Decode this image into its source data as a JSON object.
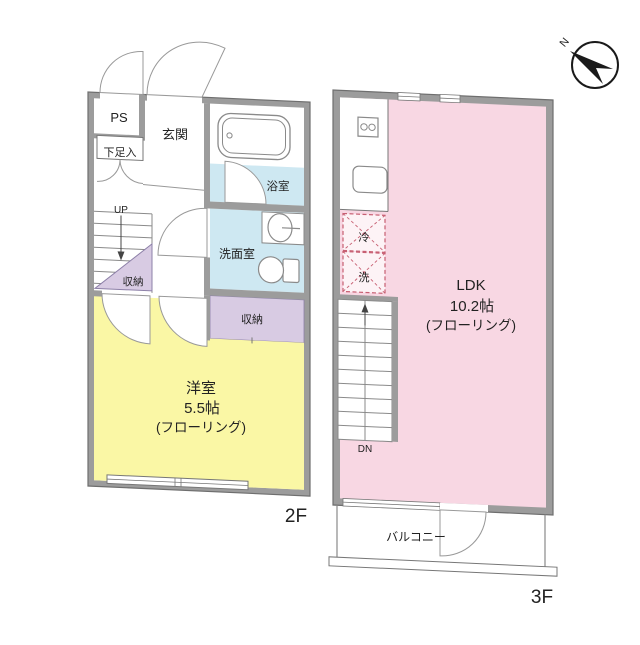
{
  "title": "maisonette floor plan",
  "compass": {
    "north_label": "N"
  },
  "colors": {
    "wall": "#9c9c9c",
    "wall_edge": "#6e6e6e",
    "room_yellow": "#faf7a5",
    "room_pink": "#f8d7e3",
    "room_blue": "#cee8f2",
    "room_purple": "#d8cbe3",
    "fixture_line": "#8a8a8a",
    "dashed_appliance": "#c75f72",
    "text": "#222222"
  },
  "floor_2f": {
    "floor_label": "2F",
    "rooms": {
      "ps": "PS",
      "genkan": "玄関",
      "shoe_box": "下足入",
      "bathroom": "浴室",
      "washroom": "洗面室",
      "closet_under_stairs": "収納",
      "closet_right": "収納",
      "stairs_direction": "UP",
      "main_room_line1": "洋室",
      "main_room_line2": "5.5帖",
      "main_room_line3": "(フローリング)"
    }
  },
  "floor_3f": {
    "floor_label": "3F",
    "rooms": {
      "ldk_line1": "LDK",
      "ldk_line2": "10.2帖",
      "ldk_line3": "(フローリング)",
      "fridge": "冷",
      "washer": "洗",
      "stairs_direction": "DN",
      "balcony": "バルコニー"
    }
  }
}
